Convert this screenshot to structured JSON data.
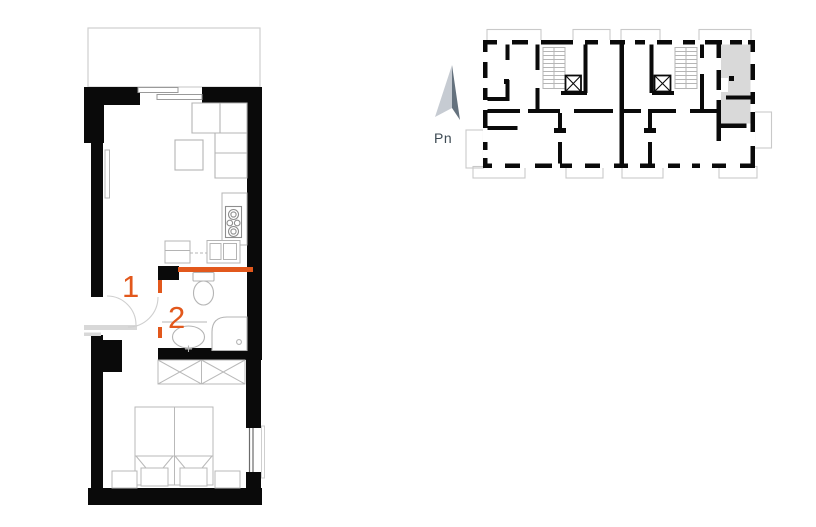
{
  "page": {
    "background": "#ffffff",
    "description_labels": {
      "room_1": "1",
      "room_2": "2",
      "compass": "Pn"
    }
  },
  "detailed_plan": {
    "room_labels": {
      "hall": "1",
      "bathroom": "2"
    },
    "highlight_color": "#e2581c",
    "wall_color": "#0a0a0a",
    "furniture_outline": "#b4b4b4"
  },
  "overview_plan": {
    "compass_label": "Pn",
    "compass_text_color": "#3d4a53",
    "highlighted_unit_fill": "#d9d9d9",
    "arrow_light": "#c6cbd2",
    "arrow_dark": "#65727e",
    "wall_color": "#0a0a0a",
    "balcony_outline": "#c9c9c9"
  }
}
